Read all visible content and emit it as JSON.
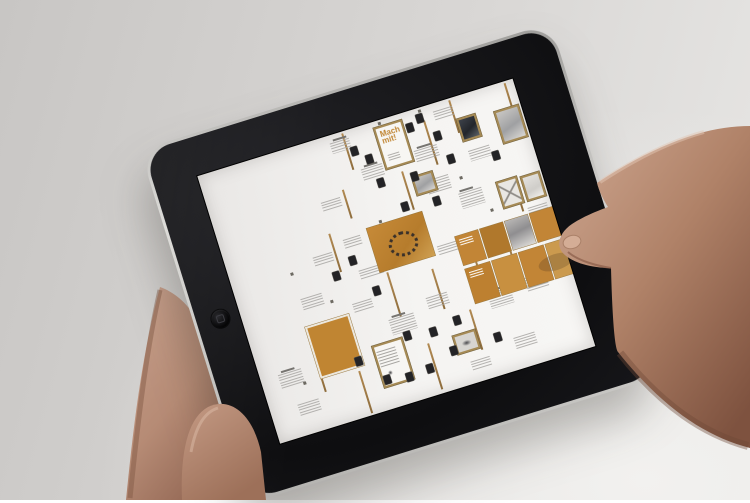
{
  "scene": {
    "alt_text": "Two hands holding a black tablet; the screen shows a design process map with orange panels, framed thumbnails and small text blocks"
  },
  "colors": {
    "background_left": "#c8c6c4",
    "background_right": "#e8e7e5",
    "bezel_black": "#121214",
    "rim_silver": "#c6c5c2",
    "screen_white": "#f4f3f1",
    "accent_orange": "#c08532",
    "accent_orange_light": "#cfa052",
    "frame_tan": "#a58a55",
    "text_gray": "#a8a6a3",
    "thumbnail_dark": "#232326",
    "skin": "#c59a85",
    "skin_shadow": "#8f6350"
  },
  "ipad": {
    "home_button_icon": "rounded-square-icon",
    "screen": {
      "poster_title": "Mach mit!",
      "items": [
        {
          "t": "vline",
          "x": 150,
          "y": 2,
          "h": 38
        },
        {
          "t": "vline",
          "x": 196,
          "y": 56,
          "h": 40
        },
        {
          "t": "vline",
          "x": 232,
          "y": 14,
          "h": 46
        },
        {
          "t": "vline",
          "x": 262,
          "y": 2,
          "h": 34
        },
        {
          "t": "vline",
          "x": 134,
          "y": 56,
          "h": 30
        },
        {
          "t": "vline",
          "x": 108,
          "y": 94,
          "h": 40
        },
        {
          "t": "vline",
          "x": 152,
          "y": 148,
          "h": 46
        },
        {
          "t": "vline",
          "x": 196,
          "y": 158,
          "h": 42
        },
        {
          "t": "vline",
          "x": 240,
          "y": 148,
          "h": 48
        },
        {
          "t": "vline",
          "x": 276,
          "y": 148,
          "h": 42
        },
        {
          "t": "vline",
          "x": 58,
          "y": 194,
          "h": 50
        },
        {
          "t": "vline",
          "x": 96,
          "y": 234,
          "h": 44
        },
        {
          "t": "vline",
          "x": 170,
          "y": 228,
          "h": 48
        },
        {
          "t": "vline",
          "x": 220,
          "y": 208,
          "h": 42
        },
        {
          "t": "vline",
          "x": 300,
          "y": 94,
          "h": 36
        },
        {
          "t": "vline",
          "x": 320,
          "y": 2,
          "h": 30
        },
        {
          "t": "text",
          "x": 136,
          "y": 8,
          "w": 20,
          "h": 11
        },
        {
          "t": "text",
          "x": 158,
          "y": 42,
          "w": 22,
          "h": 13
        },
        {
          "t": "text",
          "x": 214,
          "y": 40,
          "w": 24,
          "h": 12
        },
        {
          "t": "text",
          "x": 244,
          "y": 8,
          "w": 20,
          "h": 10
        },
        {
          "t": "text",
          "x": 266,
          "y": 56,
          "w": 22,
          "h": 11
        },
        {
          "t": "text",
          "x": 110,
          "y": 62,
          "w": 20,
          "h": 10
        },
        {
          "t": "text",
          "x": 216,
          "y": 72,
          "w": 24,
          "h": 14
        },
        {
          "t": "text",
          "x": 244,
          "y": 94,
          "w": 24,
          "h": 16
        },
        {
          "t": "text",
          "x": 178,
          "y": 118,
          "w": 22,
          "h": 12
        },
        {
          "t": "text",
          "x": 126,
          "y": 138,
          "w": 24,
          "h": 10
        },
        {
          "t": "text",
          "x": 208,
          "y": 138,
          "w": 22,
          "h": 10
        },
        {
          "t": "text",
          "x": 62,
          "y": 148,
          "w": 22,
          "h": 12
        },
        {
          "t": "text",
          "x": 140,
          "y": 194,
          "w": 26,
          "h": 16
        },
        {
          "t": "text",
          "x": 182,
          "y": 184,
          "w": 22,
          "h": 12
        },
        {
          "t": "text",
          "x": 242,
          "y": 198,
          "w": 24,
          "h": 16
        },
        {
          "t": "text",
          "x": 282,
          "y": 194,
          "w": 22,
          "h": 14
        },
        {
          "t": "text",
          "x": 18,
          "y": 214,
          "w": 24,
          "h": 14
        },
        {
          "t": "text",
          "x": 28,
          "y": 248,
          "w": 22,
          "h": 12
        },
        {
          "t": "text",
          "x": 110,
          "y": 168,
          "w": 20,
          "h": 10
        },
        {
          "t": "text",
          "x": 306,
          "y": 128,
          "w": 20,
          "h": 12
        },
        {
          "t": "text",
          "x": 254,
          "y": 248,
          "w": 22,
          "h": 12
        },
        {
          "t": "text",
          "x": 206,
          "y": 258,
          "w": 20,
          "h": 10
        },
        {
          "t": "text",
          "x": 86,
          "y": 112,
          "w": 20,
          "h": 10
        },
        {
          "t": "text",
          "x": 120,
          "y": 104,
          "w": 18,
          "h": 9
        },
        {
          "t": "head",
          "x": 140,
          "y": 5
        },
        {
          "t": "head",
          "x": 162,
          "y": 39
        },
        {
          "t": "head",
          "x": 218,
          "y": 37
        },
        {
          "t": "head",
          "x": 246,
          "y": 91
        },
        {
          "t": "head",
          "x": 144,
          "y": 191
        },
        {
          "t": "head",
          "x": 246,
          "y": 195
        },
        {
          "t": "head",
          "x": 22,
          "y": 211
        },
        {
          "t": "head",
          "x": 286,
          "y": 191
        },
        {
          "t": "thumb",
          "x": 154,
          "y": 18
        },
        {
          "t": "thumb",
          "x": 166,
          "y": 30
        },
        {
          "t": "thumb",
          "x": 214,
          "y": 12
        },
        {
          "t": "thumb",
          "x": 226,
          "y": 6
        },
        {
          "t": "thumb",
          "x": 238,
          "y": 28
        },
        {
          "t": "thumb",
          "x": 244,
          "y": 54
        },
        {
          "t": "thumb",
          "x": 204,
          "y": 60
        },
        {
          "t": "thumb",
          "x": 170,
          "y": 56
        },
        {
          "t": "thumb",
          "x": 186,
          "y": 86
        },
        {
          "t": "thumb",
          "x": 218,
          "y": 90
        },
        {
          "t": "thumb",
          "x": 120,
          "y": 122
        },
        {
          "t": "thumb",
          "x": 100,
          "y": 132
        },
        {
          "t": "thumb",
          "x": 134,
          "y": 158
        },
        {
          "t": "thumb",
          "x": 150,
          "y": 210
        },
        {
          "t": "thumb",
          "x": 176,
          "y": 214
        },
        {
          "t": "thumb",
          "x": 202,
          "y": 210
        },
        {
          "t": "thumb",
          "x": 96,
          "y": 220
        },
        {
          "t": "thumb",
          "x": 118,
          "y": 246
        },
        {
          "t": "thumb",
          "x": 140,
          "y": 250
        },
        {
          "t": "thumb",
          "x": 162,
          "y": 248
        },
        {
          "t": "thumb",
          "x": 236,
          "y": 238
        },
        {
          "t": "thumb",
          "x": 190,
          "y": 238
        },
        {
          "t": "thumb",
          "x": 288,
          "y": 64
        },
        {
          "t": "speck",
          "x": 188,
          "y": 2
        },
        {
          "t": "speck",
          "x": 250,
          "y": 78
        },
        {
          "t": "speck",
          "x": 160,
          "y": 96
        },
        {
          "t": "speck",
          "x": 90,
          "y": 158
        },
        {
          "t": "speck",
          "x": 40,
          "y": 228
        },
        {
          "t": "speck",
          "x": 270,
          "y": 118
        },
        {
          "t": "speck",
          "x": 230,
          "y": 2
        },
        {
          "t": "speck",
          "x": 60,
          "y": 120
        },
        {
          "t": "speck",
          "x": 310,
          "y": 160
        },
        {
          "t": "poster",
          "x": 182,
          "y": 6,
          "w": 30,
          "h": 44
        },
        {
          "t": "photodark",
          "x": 264,
          "y": 22,
          "w": 20,
          "h": 24
        },
        {
          "t": "photo",
          "x": 302,
          "y": 26,
          "w": 26,
          "h": 34
        },
        {
          "t": "photo",
          "x": 204,
          "y": 64,
          "w": 22,
          "h": 20
        },
        {
          "t": "photox",
          "x": 283,
          "y": 94,
          "w": 22,
          "h": 28
        },
        {
          "t": "photopale",
          "x": 308,
          "y": 96,
          "w": 20,
          "h": 26
        },
        {
          "t": "ring",
          "x": 146,
          "y": 100,
          "w": 58,
          "h": 46
        },
        {
          "t": "orange",
          "x": 58,
          "y": 176,
          "w": 46,
          "h": 54
        },
        {
          "t": "slide",
          "x": 228,
          "y": 134,
          "w": 24,
          "h": 30,
          "c": "#c28536",
          "tl": 1
        },
        {
          "t": "slide",
          "x": 254,
          "y": 134,
          "w": 24,
          "h": 30,
          "c": "#b0782c"
        },
        {
          "t": "slidegray",
          "x": 280,
          "y": 134,
          "w": 24,
          "h": 30
        },
        {
          "t": "slide",
          "x": 306,
          "y": 134,
          "w": 24,
          "h": 30,
          "c": "#c28536"
        },
        {
          "t": "slide",
          "x": 228,
          "y": 168,
          "w": 26,
          "h": 36,
          "c": "#bd8030",
          "tl": 1
        },
        {
          "t": "slide",
          "x": 256,
          "y": 168,
          "w": 26,
          "h": 36,
          "c": "#c89040"
        },
        {
          "t": "slide",
          "x": 284,
          "y": 168,
          "w": 26,
          "h": 36,
          "c": "#c28536"
        },
        {
          "t": "slide",
          "x": 312,
          "y": 168,
          "w": 18,
          "h": 36,
          "c": "#cb9a4e"
        },
        {
          "t": "posterb",
          "x": 116,
          "y": 214,
          "w": 32,
          "h": 44
        },
        {
          "t": "photocar",
          "x": 196,
          "y": 228,
          "w": 24,
          "h": 20
        }
      ]
    }
  }
}
